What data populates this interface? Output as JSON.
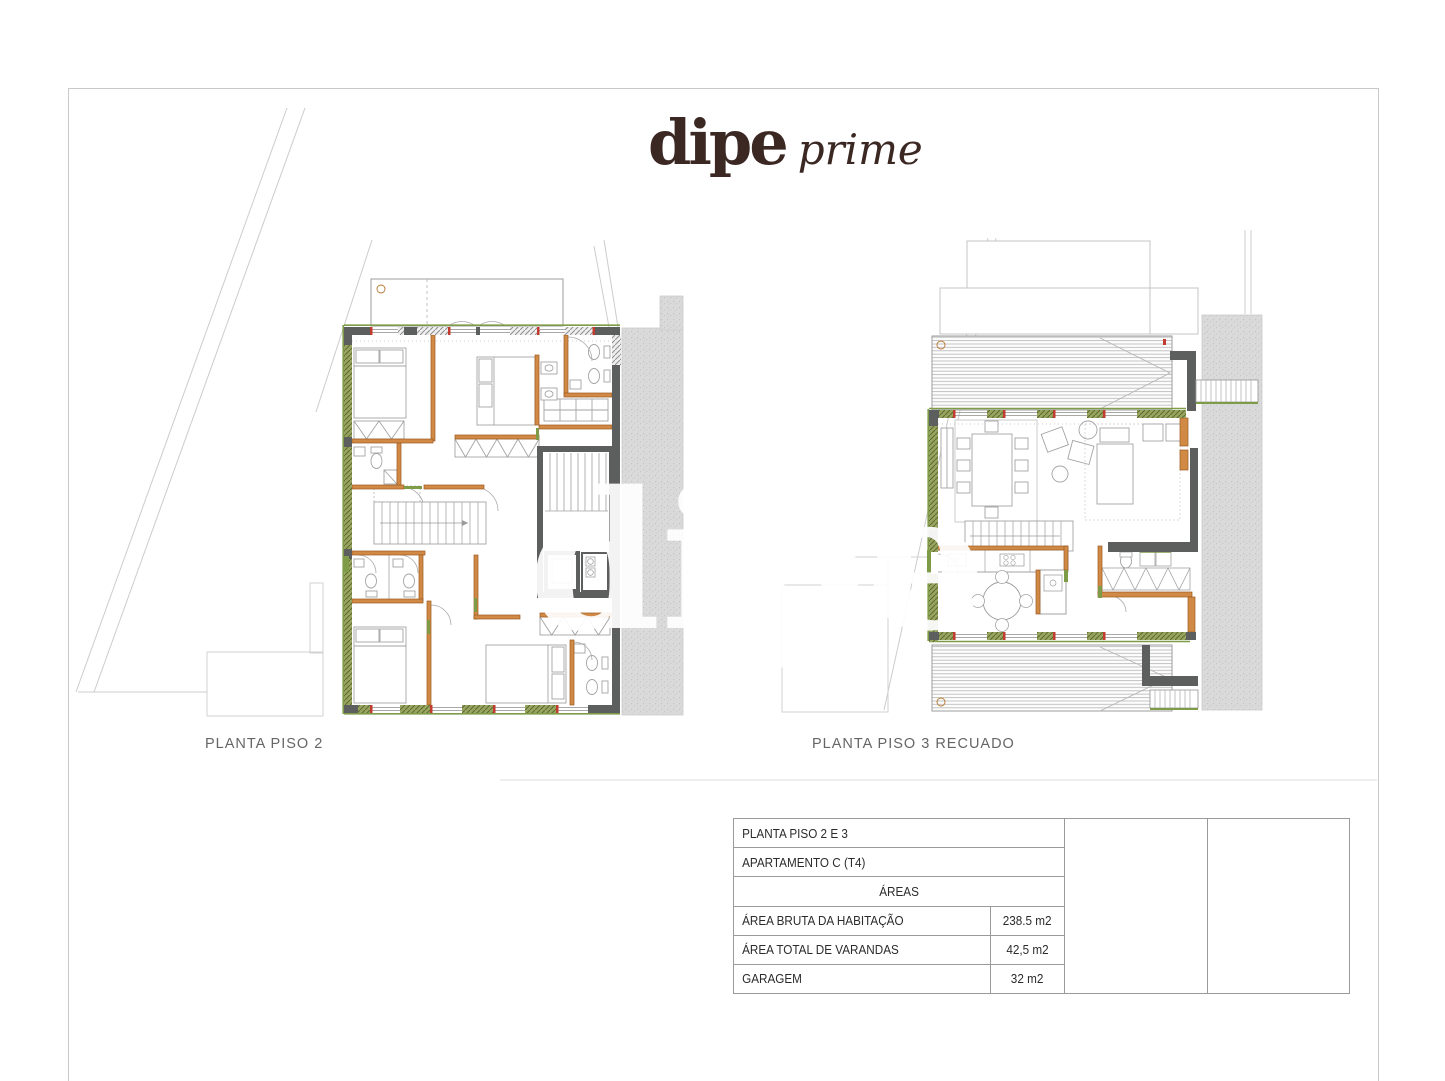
{
  "logo": {
    "brand": "dipe",
    "suffix": "prime",
    "color": "#3b2823"
  },
  "watermark": {
    "text": "dipe"
  },
  "plans": {
    "left": {
      "label": "PLANTA PISO 2"
    },
    "right": {
      "label": "PLANTA PISO 3 RECUADO"
    }
  },
  "title_block": {
    "row1": "PLANTA PISO 2 E 3",
    "row2": "APARTAMENTO C (T4)",
    "header": "ÁREAS",
    "areas": [
      {
        "label": "ÁREA BRUTA DA HABITAÇÃO",
        "value": "238.5 m2"
      },
      {
        "label": "ÁREA TOTAL DE VARANDAS",
        "value": "42,5 m2"
      },
      {
        "label": "GARAGEM",
        "value": "32 m2"
      }
    ]
  },
  "colors": {
    "accent_green": "#7e9b48",
    "wall_dark": "#5d5e5e",
    "wall_orange": "#d18a45",
    "logo_brown": "#3b2823",
    "sidewalk_gray": "#dadada"
  }
}
